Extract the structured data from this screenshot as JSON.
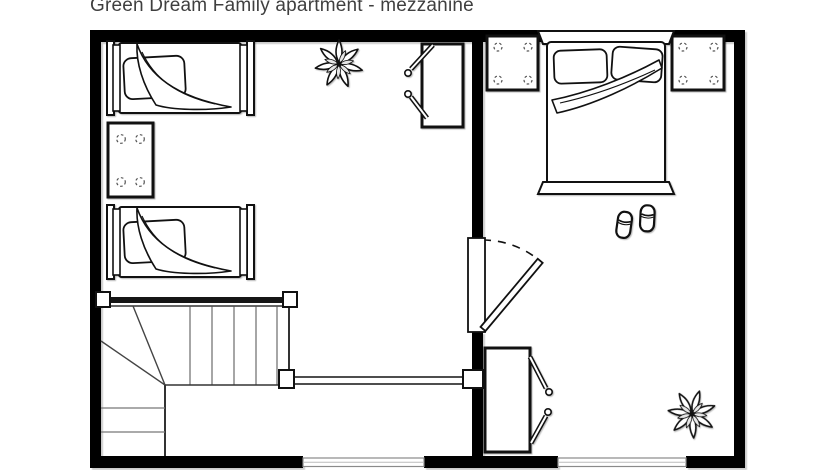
{
  "title": "Green Dream Family apartment - mezzanine",
  "colors": {
    "walls": "#000000",
    "furniture_outline": "#111111",
    "stair_treads": "#777777",
    "background": "#ffffff",
    "title_text": "#3f3f3f"
  },
  "floorplan": {
    "floor": "mezzanine",
    "left_room": {
      "furniture": [
        "single bed with pillow and folded blanket",
        "table with four seats",
        "second single bed with pillow and folded blanket",
        "plant",
        "desk with two chairs",
        "L-shaped staircase with winders and railings"
      ]
    },
    "right_room": {
      "furniture": [
        "double bed with two pillows and folded blanket",
        "left bedside square table",
        "right bedside square table",
        "pair of slippers",
        "desk with two chairs",
        "plant"
      ]
    },
    "openings": {
      "door": "hinged door in dividing wall, swings into right room",
      "windows": [
        "window in bottom wall of left room",
        "window in bottom wall of right room"
      ]
    }
  }
}
